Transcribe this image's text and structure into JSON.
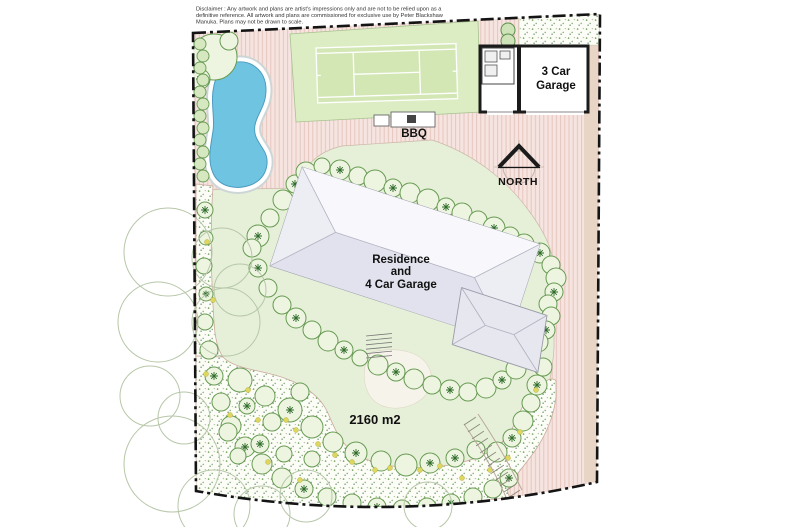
{
  "disclaimer": {
    "line1": "Disclaimer : Any artwork and plans are artist's impressions only and are not to be relied upon as a",
    "line2": "definitive reference. All artwork and plans are commissioned for exclusive use by Peter Blackshaw",
    "line3": "Manuka. Plans may not be drawn to scale."
  },
  "labels": {
    "garage_line1": "3 Car",
    "garage_line2": "Garage",
    "bbq": "BBQ",
    "north": "NORTH",
    "residence_line1": "Residence",
    "residence_line2": "and",
    "residence_line3": "4 Car Garage",
    "area": "2160 m2"
  },
  "colors": {
    "paving": "#f5e4df",
    "paving_stripe": "#e1bcb4",
    "paving_tan": "#e9d5c5",
    "lawn": "#e6f0d8",
    "court_apron": "#dcedc4",
    "court": "#d3e7b5",
    "court_line": "#ffffff",
    "bed_dot": "#6f9e55",
    "pool": "#6fc4e1",
    "pool_rim": "#ffffff",
    "roof": "#f3f3f8",
    "roof_shade": "#e2e2ee",
    "wall": "#1b1b1b",
    "boundary": "#141414",
    "shrub_fill": "#edf5e1",
    "shrub_stroke": "#679a52",
    "star": "#2f6b2a",
    "accent_yellow": "#ddd75f",
    "text": "#111111"
  }
}
